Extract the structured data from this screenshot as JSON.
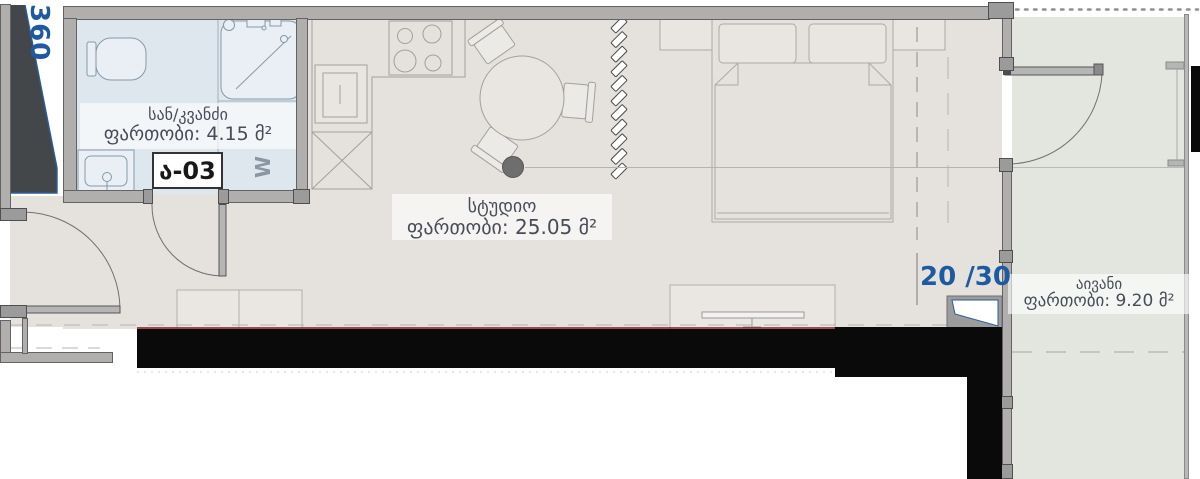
{
  "unit": {
    "number": "ა-03",
    "floor_indicator": "20 /30",
    "shaft_dimension": "360",
    "washer_label": "W"
  },
  "rooms": {
    "bathroom": {
      "name": "სან/კვანძი",
      "area": "ფართობი: 4.15 მ²"
    },
    "studio": {
      "name": "სტუდიო",
      "area": "ფართობი: 25.05 მ²"
    },
    "balcony": {
      "name": "აივანი",
      "area": "ფართობი: 9.20 მ²"
    }
  },
  "colors": {
    "floor": "#e5e2de",
    "bathroom_floor": "#dfe7ee",
    "balcony_floor": "#e2e6df",
    "wall": "#b0afad",
    "poche": "#0a0a0a",
    "accent_blue": "#1e5aa0",
    "red_line": "#7c1b1f"
  }
}
